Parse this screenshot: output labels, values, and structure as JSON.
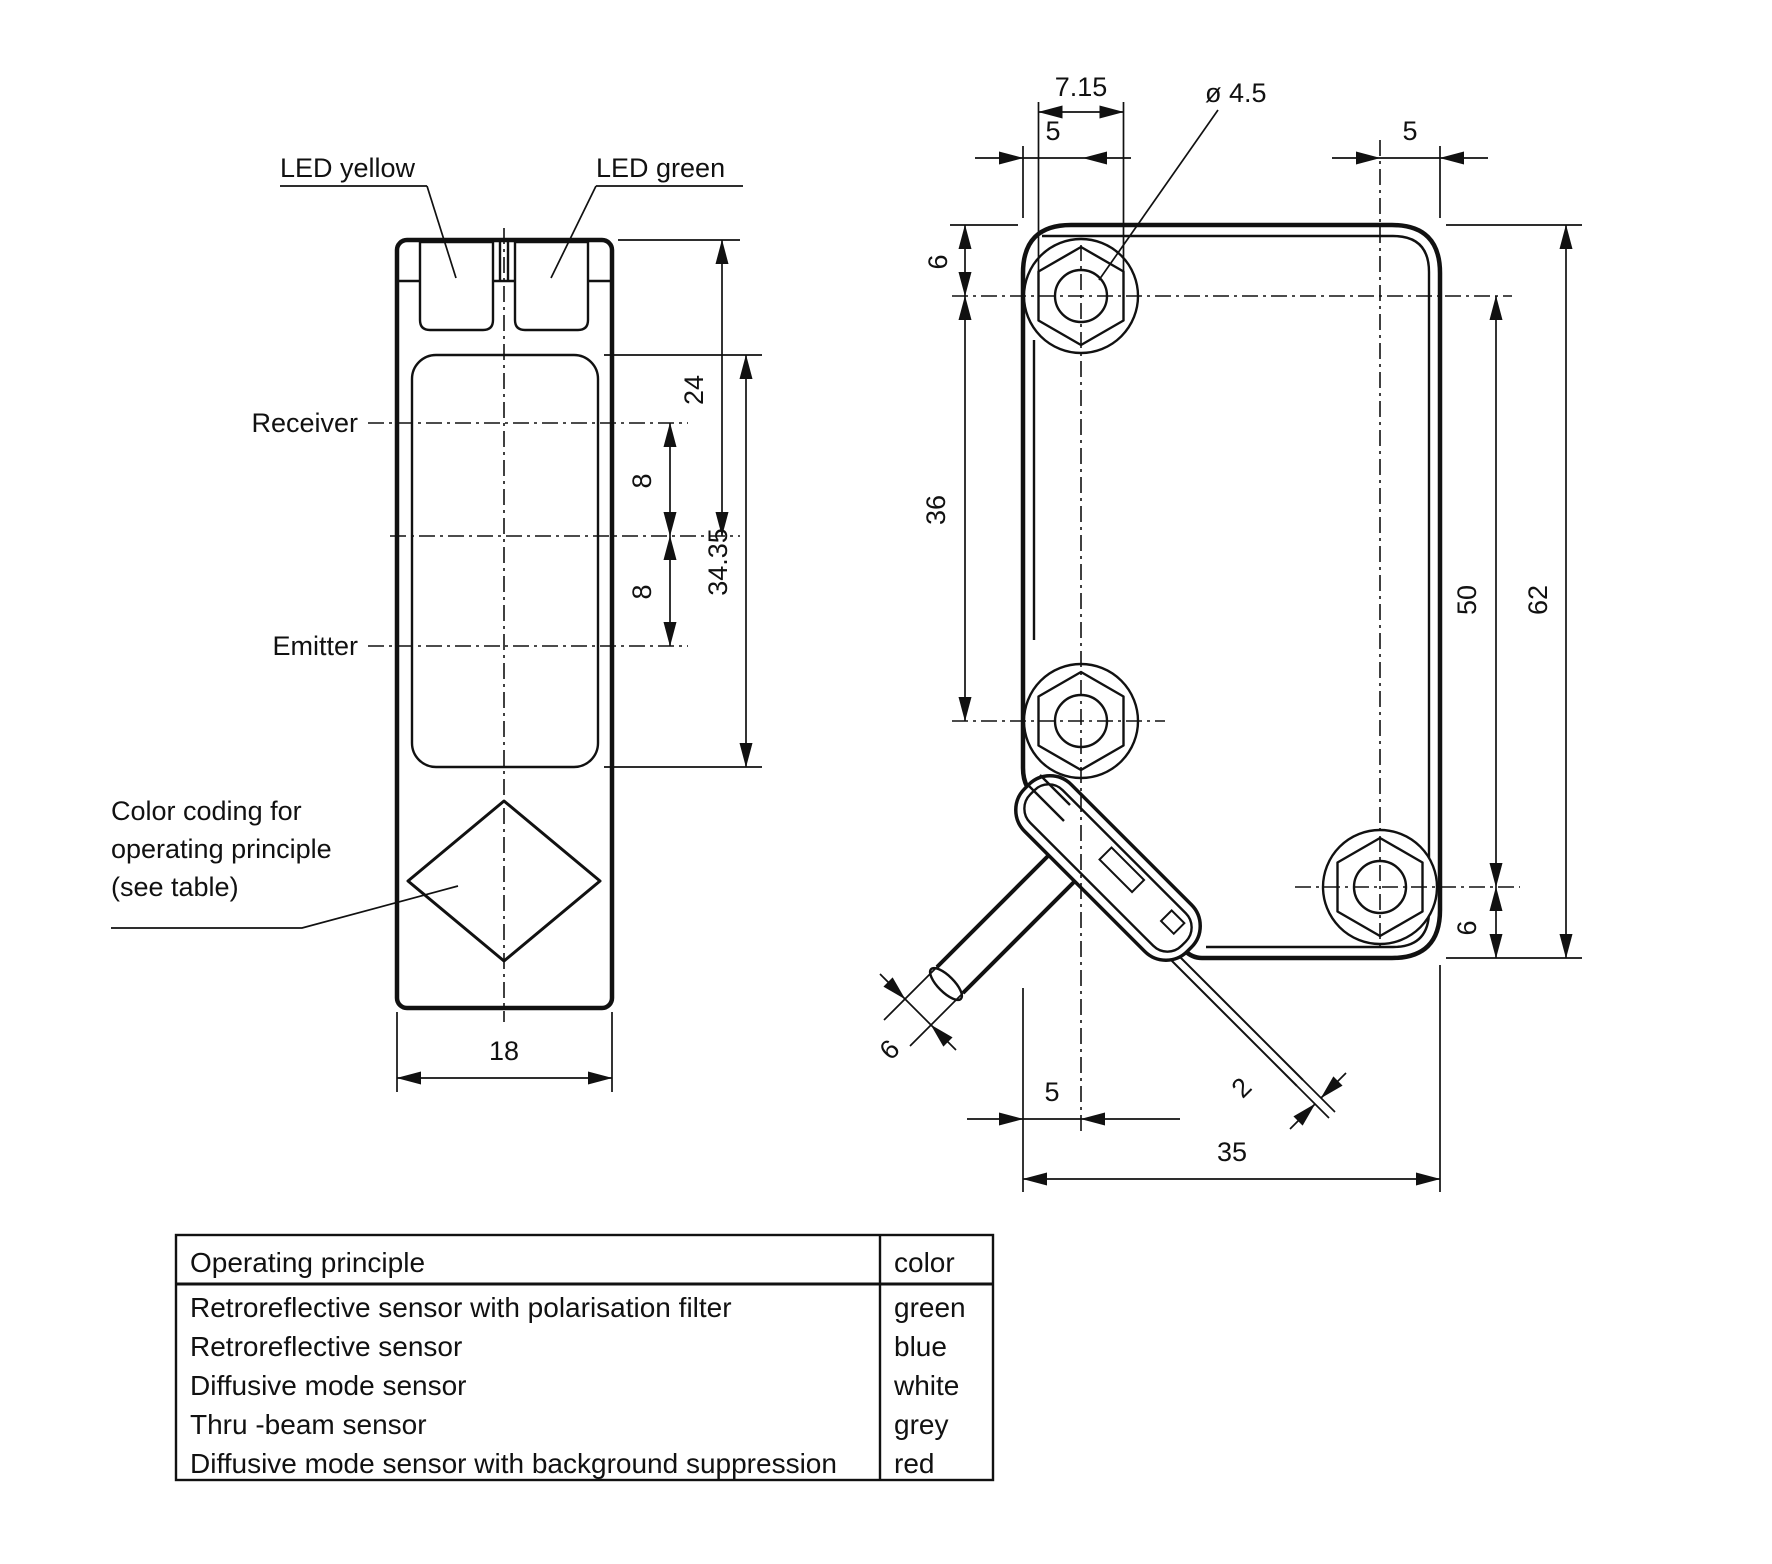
{
  "front_view": {
    "led_yellow": "LED yellow",
    "led_green": "LED green",
    "receiver": "Receiver",
    "emitter": "Emitter",
    "note_line1": "Color coding for",
    "note_line2": "operating principle",
    "note_line3": "(see table)",
    "dim_width": "18",
    "dim_top_to_center": "24",
    "dim_receiver_to_center": "8",
    "dim_center_to_emitter": "8",
    "dim_lens_height": "34.35"
  },
  "side_view": {
    "dim_hex_flats": "7.15",
    "dim_hole_diameter": "ø 4.5",
    "dim_hole_left_offset": "5",
    "dim_hole_right_offset": "5",
    "dim_hole_top_offset": "6",
    "dim_hole_spacing": "36",
    "dim_hole_span": "50",
    "dim_body_height": "62",
    "dim_hole_bottom_offset": "6",
    "dim_cable_diameter": "6",
    "dim_cable_exit_offset": "5",
    "dim_wire_diameter": "2",
    "dim_body_depth": "35"
  },
  "table": {
    "header": [
      "Operating principle",
      "color"
    ],
    "rows": [
      [
        "Retroreflective sensor with polarisation filter",
        "green"
      ],
      [
        "Retroreflective sensor",
        "blue"
      ],
      [
        "Diffusive mode sensor",
        "white"
      ],
      [
        "Thru -beam sensor",
        "grey"
      ],
      [
        "Diffusive mode sensor with background suppression",
        "red"
      ]
    ]
  }
}
